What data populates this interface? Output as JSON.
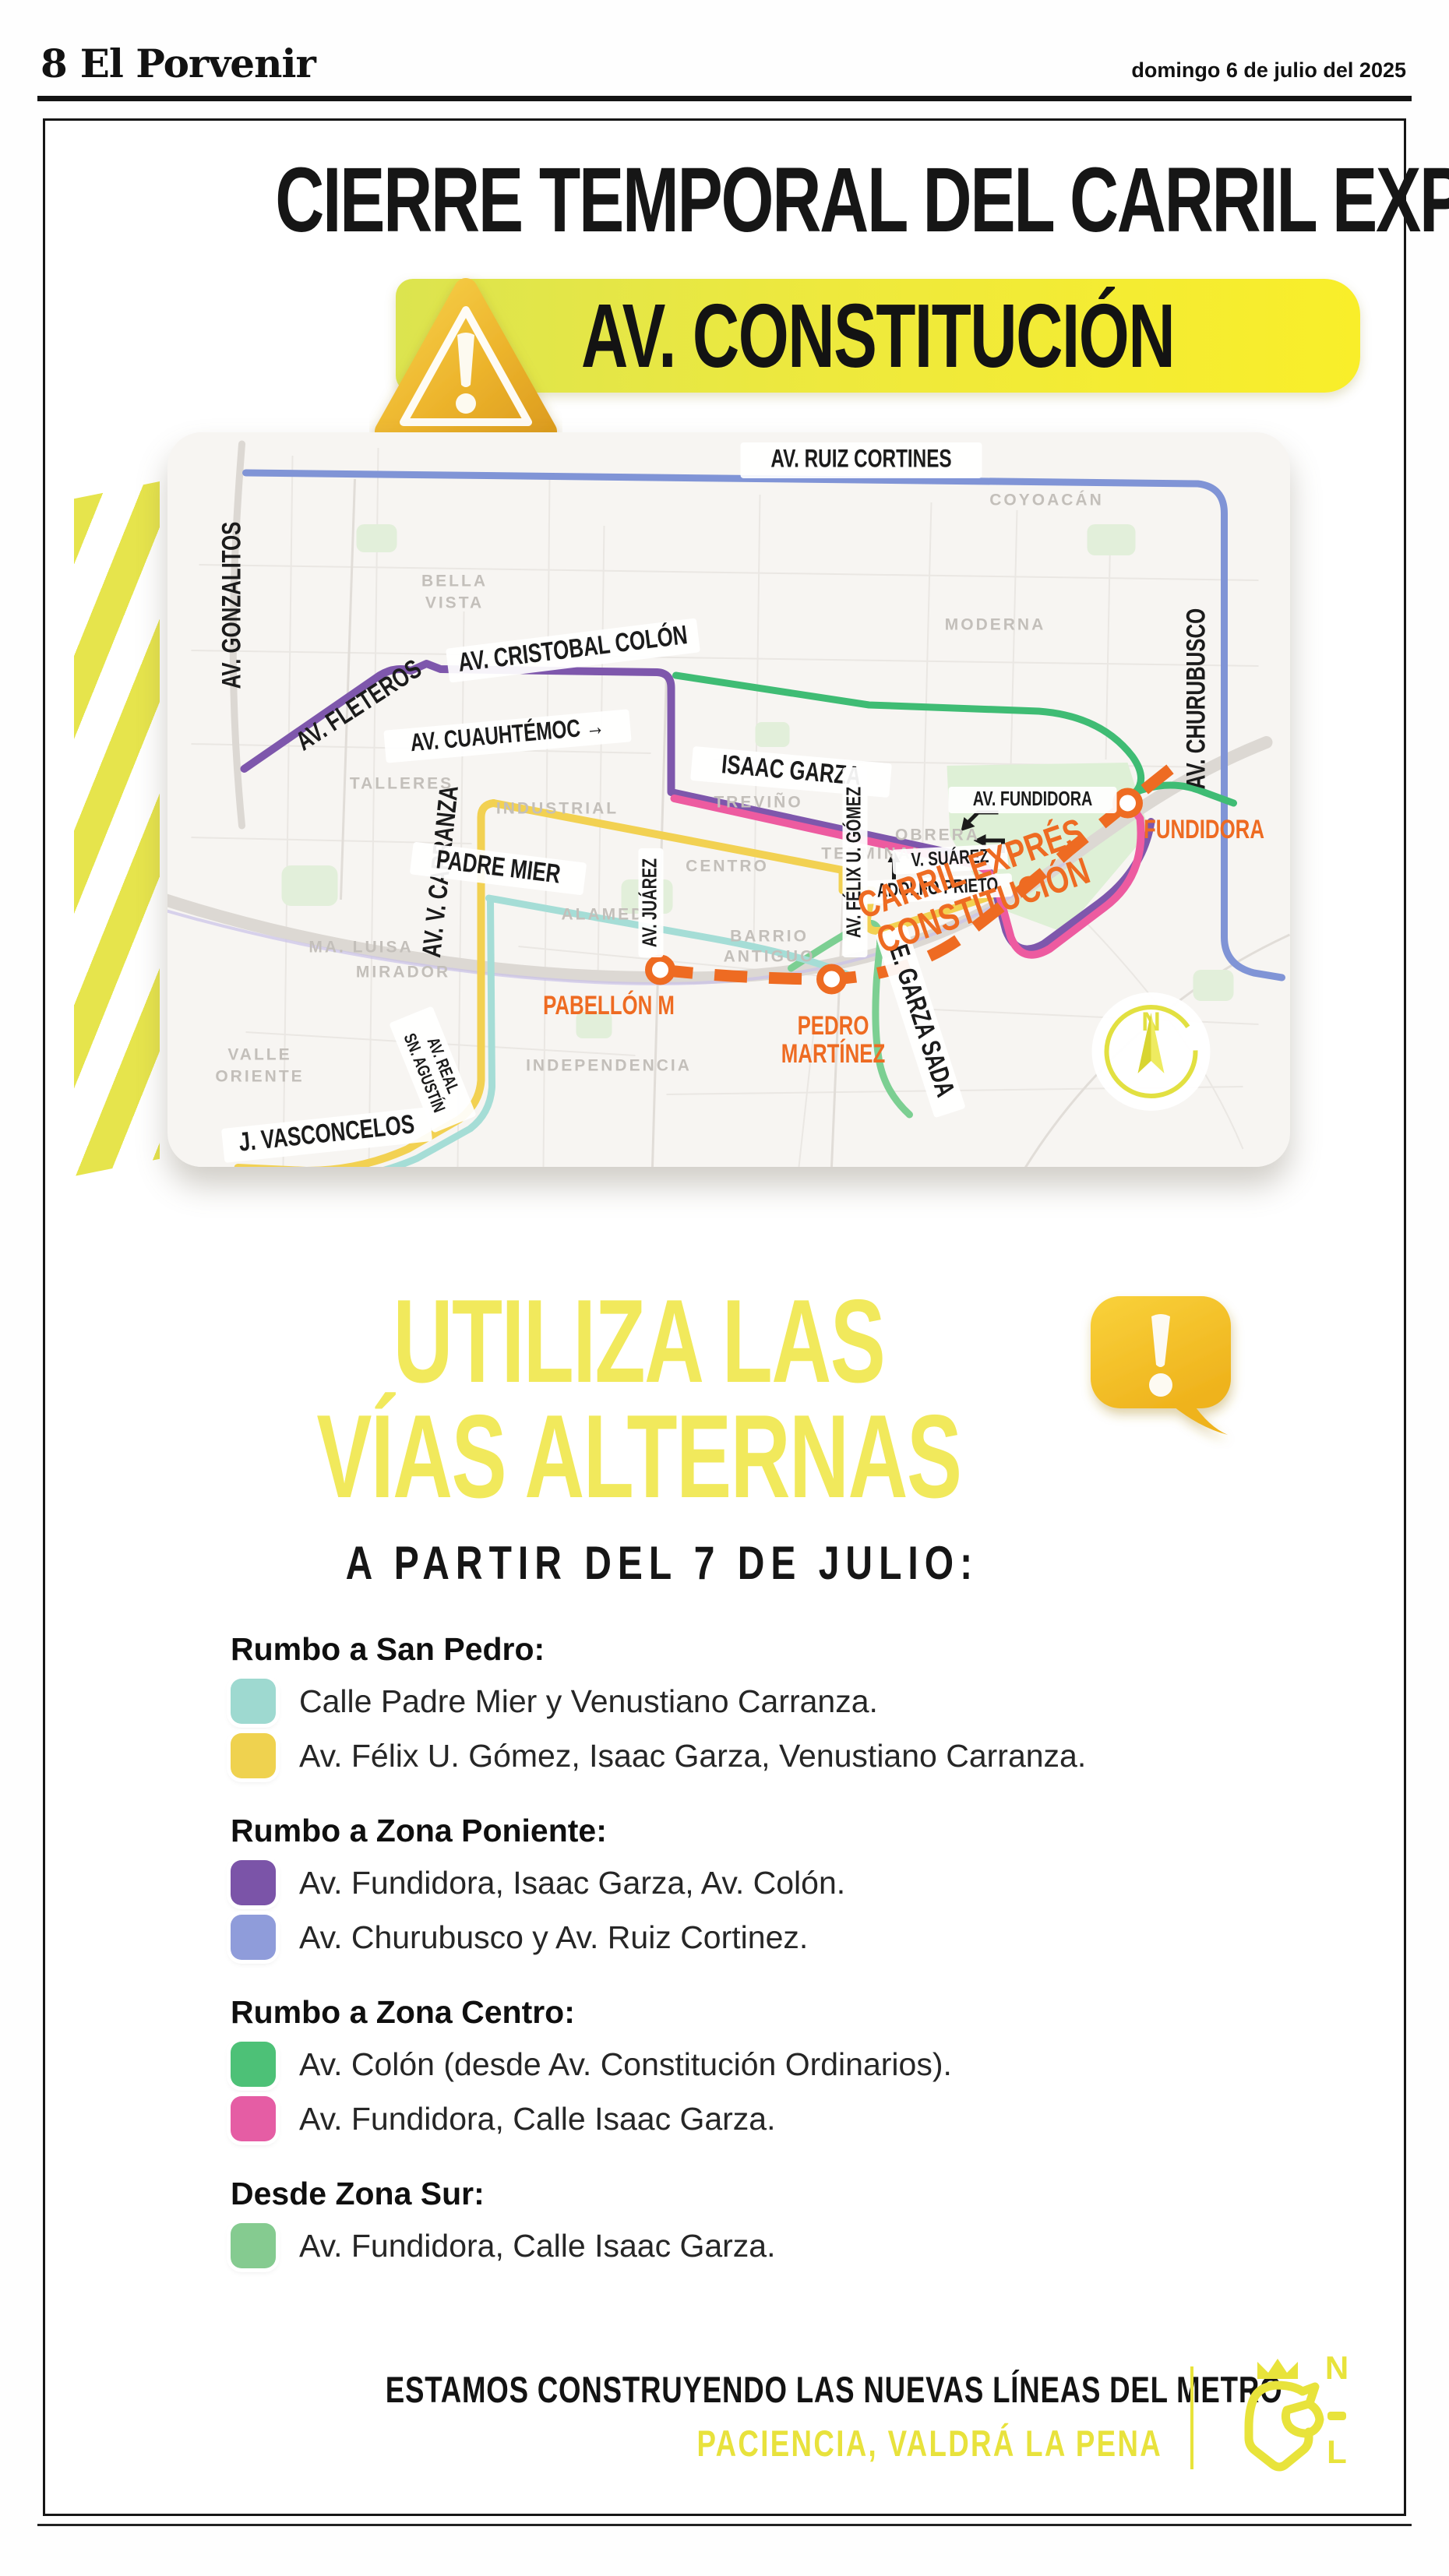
{
  "page": {
    "number": "8",
    "masthead": "El Porvenir",
    "date": "domingo 6 de julio del 2025"
  },
  "hero": {
    "title": "CIERRE TEMPORAL DEL CARRIL EXPRÉS",
    "banner": "AV. CONSTITUCIÓN"
  },
  "colors": {
    "accent_yellow": "#f1e95c",
    "banner_left": "#dce44f",
    "banner_right": "#f9ee2a",
    "orange": "#ee6b22",
    "route_blue": "#8094d6",
    "route_purple": "#7e57ac",
    "route_pink": "#ed5ba0",
    "route_green": "#3fbc74",
    "route_lightgreen": "#7ccf92",
    "route_teal": "#a5ddd6",
    "route_yellow": "#f2d152",
    "nl_yellow": "#e8e33b"
  },
  "map": {
    "streets": {
      "ruiz_cortines": "AV. RUIZ CORTINES",
      "gonzalitos": "AV. GONZALITOS",
      "churubusco": "AV. CHURUBUSCO",
      "fleteros": "AV. FLETEROS",
      "cristobal_colon": "AV. CRISTOBAL COLÓN",
      "cuauhtemoc": "AV. CUAUHTÉMOC →",
      "isaac_garza": "ISAAC GARZA",
      "v_carranza": "AV. V. CARRANZA",
      "padre_mier": "PADRE MIER",
      "juarez": "AV. JUÁREZ",
      "felix_u_gomez": "AV. FÉLIX U. GÓMEZ",
      "v_suarez": "V. SUÁREZ",
      "adolfo_prieto": "ADOLFO PRIETO",
      "av_fundidora": "AV. FUNDIDORA",
      "garza_sada": "E. GARZA SADA",
      "j_vasconcelos": "J. VASCONCELOS",
      "real_sn_agustin_1": "AV. REAL",
      "real_sn_agustin_2": "SN. AGUSTÍN",
      "carril_expres_1": "CARRIL EXPRÉS",
      "carril_expres_2": "CONSTITUCIÓN"
    },
    "stations": {
      "pabellon": "PABELLÓN M",
      "pedro_1": "PEDRO",
      "pedro_2": "MARTÍNEZ",
      "fundidora": "FUNDIDORA"
    },
    "areas": {
      "bella_1": "BELLA",
      "bella_2": "VISTA",
      "coyoacan": "COYOACÁN",
      "moderna": "MODERNA",
      "talleres": "TALLERES",
      "industrial": "INDUSTRIAL",
      "trevino": "TREVIÑO",
      "terminal": "TERMINAL",
      "obrera": "OBRERA",
      "centro": "CENTRO",
      "alameda": "ALAMEDA",
      "ma_luisa": "MA. LUISA",
      "mirador": "MIRADOR",
      "barrio_1": "BARRIO",
      "barrio_2": "ANTIGUO",
      "independencia": "INDEPENDENCIA",
      "valle_1": "VALLE",
      "valle_2": "ORIENTE"
    },
    "compass_n": "N"
  },
  "alternas": {
    "line1": "UTILIZA LAS",
    "line2": "VÍAS ALTERNAS",
    "subtitle": "A PARTIR DEL 7 DE JULIO:"
  },
  "legend": {
    "sections": [
      {
        "title": "Rumbo a San Pedro:",
        "items": [
          {
            "swatch": "#9ed9d0",
            "swatch_style": "background:#9ed9d0",
            "text": "Calle Padre Mier y Venustiano Carranza."
          },
          {
            "swatch": "#efd24f",
            "swatch_style": "background:#efd24f",
            "text": "Av. Félix U. Gómez, Isaac Garza, Venustiano Carranza."
          }
        ]
      },
      {
        "title": "Rumbo a Zona Poniente:",
        "items": [
          {
            "swatch": "#7b54a8",
            "swatch_style": "background:#7b54a8",
            "text": "Av. Fundidora, Isaac Garza, Av. Colón."
          },
          {
            "swatch": "#8f9cda",
            "swatch_style": "background:#8f9cda",
            "text": "Av. Churubusco y Av. Ruiz Cortinez."
          }
        ]
      },
      {
        "title": "Rumbo a Zona Centro:",
        "items": [
          {
            "swatch": "#4dc177",
            "swatch_style": "background:#4dc177",
            "text": "Av. Colón (desde Av. Constitución Ordinarios)."
          },
          {
            "swatch": "#e55da4",
            "swatch_style": "background:#e55da4",
            "text": "Av. Fundidora, Calle Isaac Garza."
          }
        ]
      },
      {
        "title": "Desde Zona Sur:",
        "items": [
          {
            "swatch": "#85cb90",
            "swatch_style": "background:#85cb90",
            "text": "Av. Fundidora, Calle Isaac Garza."
          }
        ]
      }
    ]
  },
  "footer": {
    "line1": "ESTAMOS CONSTRUYENDO LAS NUEVAS LÍNEAS DEL METRO",
    "line2": "PACIENCIA, VALDRÁ LA PENA",
    "logo_n": "N",
    "logo_l": "L"
  }
}
